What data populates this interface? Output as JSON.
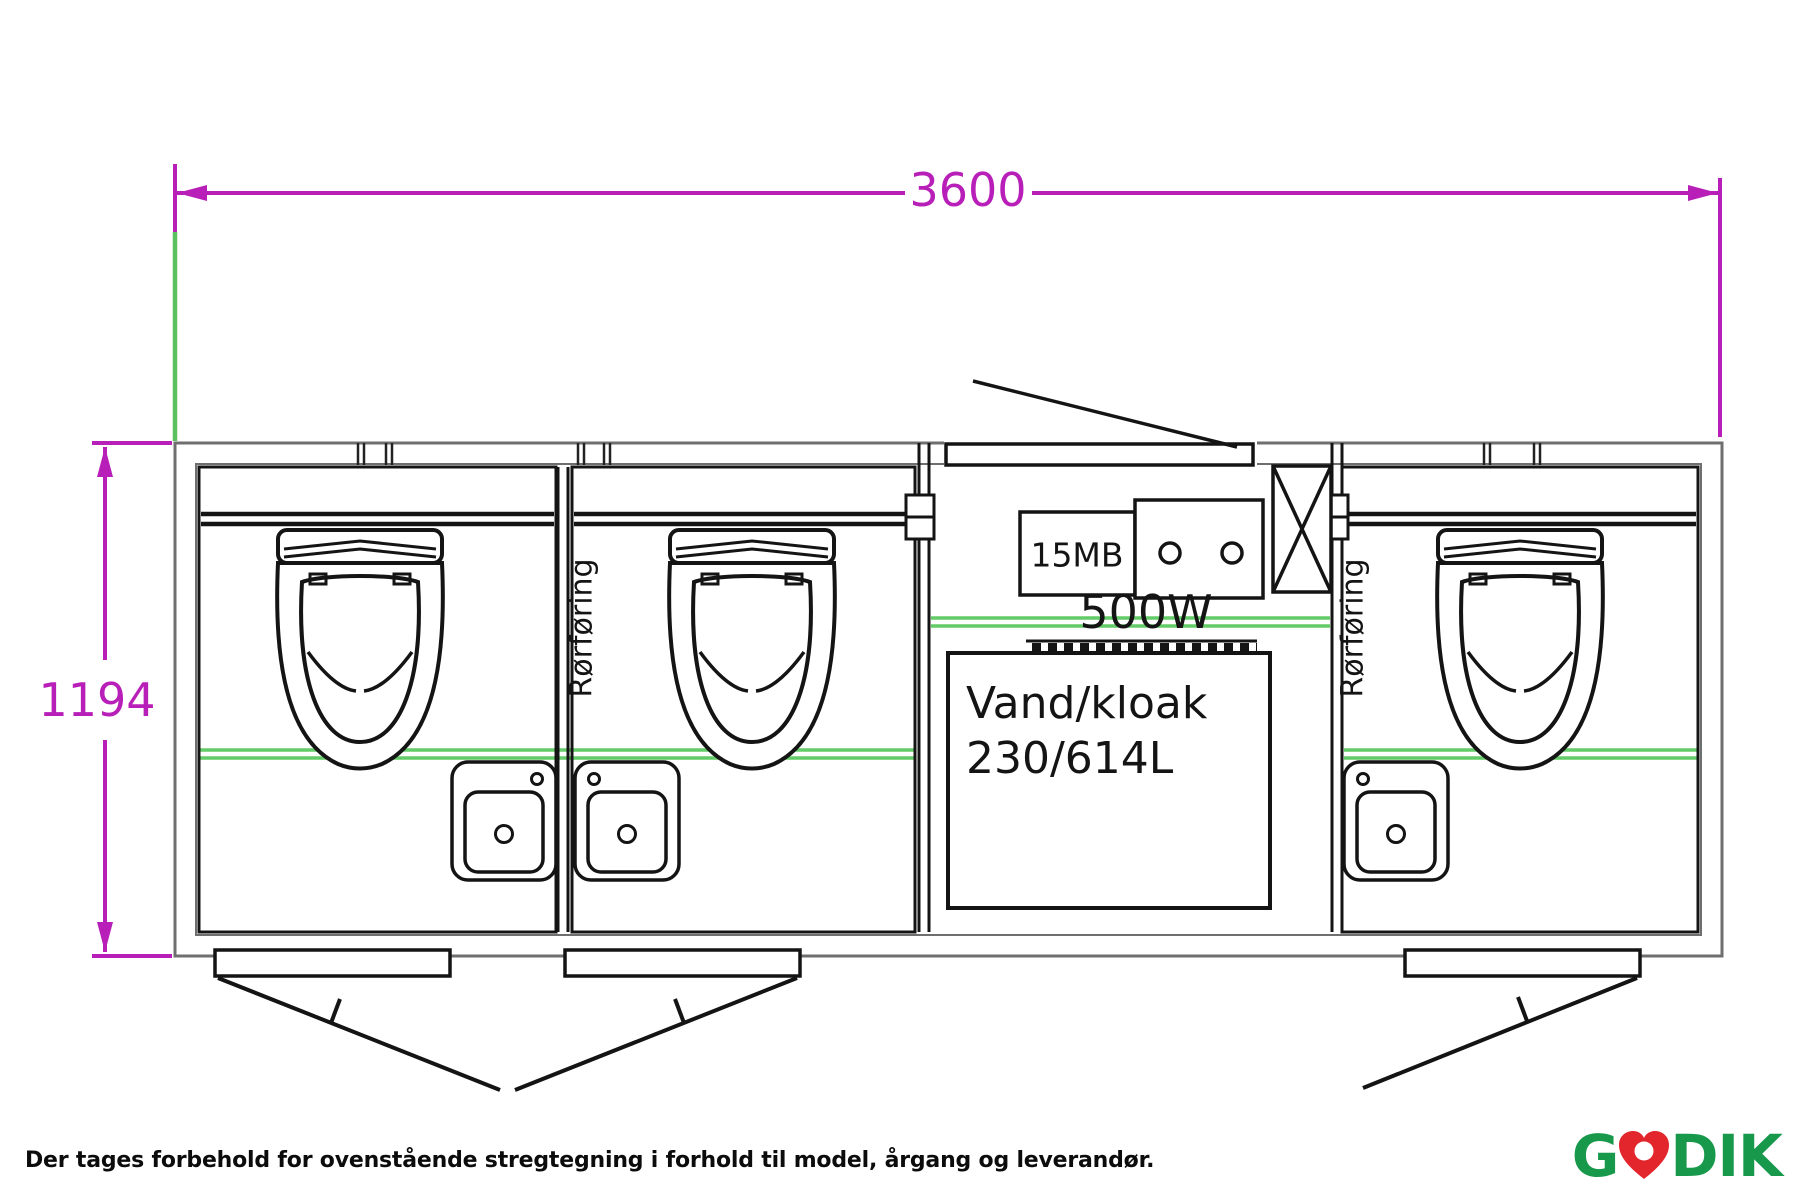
{
  "dimension_labels": {
    "width": "3600",
    "height": "1194"
  },
  "annotations": {
    "meter_box": "15MB",
    "heater": "500W",
    "tank_line1": "Vand/kloak",
    "tank_line2": "230/614L",
    "pipe_duct_left": "Rørføring",
    "pipe_duct_right": "Rørføring"
  },
  "footer": {
    "disclaimer": "Der tages forbehold for ovenstående stregtegning i forhold til model, årgang og leverandør.",
    "logo_g": "G",
    "logo_dik": "DIK"
  },
  "colors": {
    "dimension_magenta": "#b81fb8",
    "extension_green": "#5abf5e",
    "utility_green": "#63cc68",
    "line_black": "#141414",
    "wall_gray": "#6f6f6f",
    "logo_green": "#17984b",
    "logo_red": "#e3262c"
  }
}
